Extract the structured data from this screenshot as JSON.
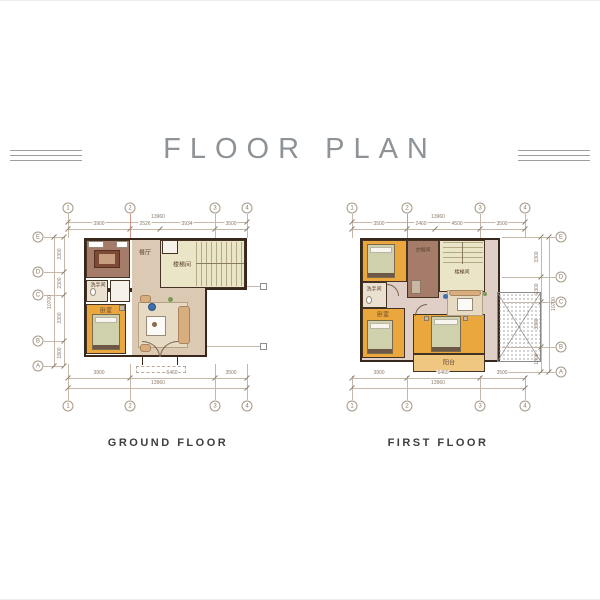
{
  "header": {
    "title": "FLOOR PLAN"
  },
  "plans": [
    {
      "caption": "GROUND FLOOR",
      "grid_top": [
        "1",
        "2",
        "3",
        "4"
      ],
      "grid_bottom": [
        "1",
        "2",
        "3",
        "4"
      ],
      "grid_left": [
        "E",
        "D",
        "C",
        "B",
        "A"
      ],
      "dims": {
        "top_total": "13960",
        "top_segments": [
          "3900",
          "2526",
          "3934",
          "3500"
        ],
        "bottom_segments": [
          "3900",
          "6460",
          "3500"
        ],
        "bottom_total": "13960",
        "left_segments": [
          "3300",
          "2300",
          "3300",
          "1800"
        ],
        "left_total": "10700"
      },
      "rooms": {
        "dining": "餐厅",
        "stairs": "楼梯间",
        "bathroom": "洗手间",
        "bedroom": "卧室"
      }
    },
    {
      "caption": "FIRST FLOOR",
      "grid_top": [
        "1",
        "2",
        "3",
        "4"
      ],
      "grid_bottom": [
        "1",
        "2",
        "3",
        "4"
      ],
      "grid_right": [
        "E",
        "D",
        "C",
        "B",
        "A"
      ],
      "dims": {
        "top_total": "13960",
        "top_segments": [
          "3500",
          "2460",
          "4500",
          "3500"
        ],
        "bottom_segments": [
          "3900",
          "6460",
          "3500"
        ],
        "bottom_total": "13960",
        "right_segments": [
          "3300",
          "2300",
          "3300",
          "1800"
        ],
        "right_total": "10700"
      },
      "rooms": {
        "wardrobe": "衣帽间",
        "stairs": "楼梯间",
        "bathroom": "洗手间",
        "bedroom": "卧室",
        "balcony": "阳台"
      }
    }
  ],
  "colors": {
    "wall": "#38281c",
    "bedroom_floor": "#e9a73e",
    "living_floor": "#dcc9b3",
    "stair_floor": "#e9e5c6",
    "wardrobe_floor": "#a57c6a",
    "hall_floor": "#dfcfc7",
    "balcony_floor": "#f0c781",
    "accent_red": "#d29788"
  }
}
